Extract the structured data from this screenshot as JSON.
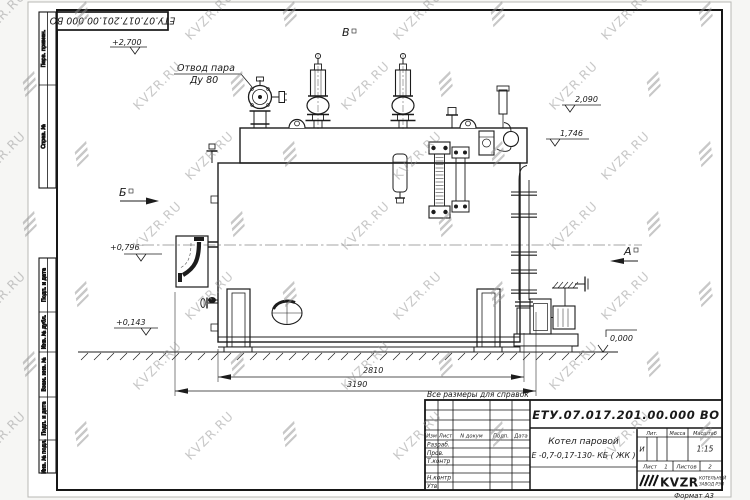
{
  "watermark": {
    "text": "KVZR.RU"
  },
  "frame": {
    "doc_number_top": "ЕТУ.07.017.201.00.000  ВО",
    "margin_cells": {
      "perv_primen": "Перв. примен.",
      "sprav_no": "Справ. №",
      "podp_data_1": "Подп. и дата",
      "inv_dubl": "Инв. № дубл.",
      "vzam_inv": "Взам. инв. №",
      "podp_data_2": "Подп. и дата",
      "inv_podl": "Инв. № подл."
    },
    "format_label": "Формат А3"
  },
  "drawing": {
    "note": "Все размеры для справок",
    "labels": {
      "steam_outlet_1": "Отвод пара",
      "steam_outlet_2": "Ду 80",
      "view_v": "В",
      "view_b": "Б",
      "view_a": "А"
    },
    "elevations": {
      "e2700": "+2,700",
      "e2090": "2,090",
      "e1746": "1,746",
      "e0796": "+0,796",
      "e0143": "+0,143",
      "e0000": "0,000"
    },
    "dimensions": {
      "d2810": "2810",
      "d3190": "3190"
    }
  },
  "title_block": {
    "doc_number": "ЕТУ.07.017.201.00.000  ВО",
    "product_name_1": "Котел паровой",
    "product_name_2": "Е -0,7-0,17-130- КБ ( ЖК )",
    "header": {
      "izm": "Изм",
      "list": "Лист",
      "n_dokum": "N докум",
      "podp": "Подп.",
      "data": "Дата"
    },
    "roles": {
      "razrab": "Разраб.",
      "prov": "Пров.",
      "tkontr": "Т.контр",
      "nkontr": "Н.контр",
      "utv": "Утв."
    },
    "lit_header": "Лит.",
    "massa_header": "Масса",
    "masshtab_header": "Масштаб",
    "lit_value": "И",
    "scale_value": "1:15",
    "list_label": "Лист",
    "list_value": "1",
    "listov_label": "Листов",
    "listov_value": "2",
    "logo": {
      "name": "KVZR",
      "sub1": "КОТЕЛЬНЫЙ",
      "sub2": "ЗАВОД РЭП"
    }
  }
}
